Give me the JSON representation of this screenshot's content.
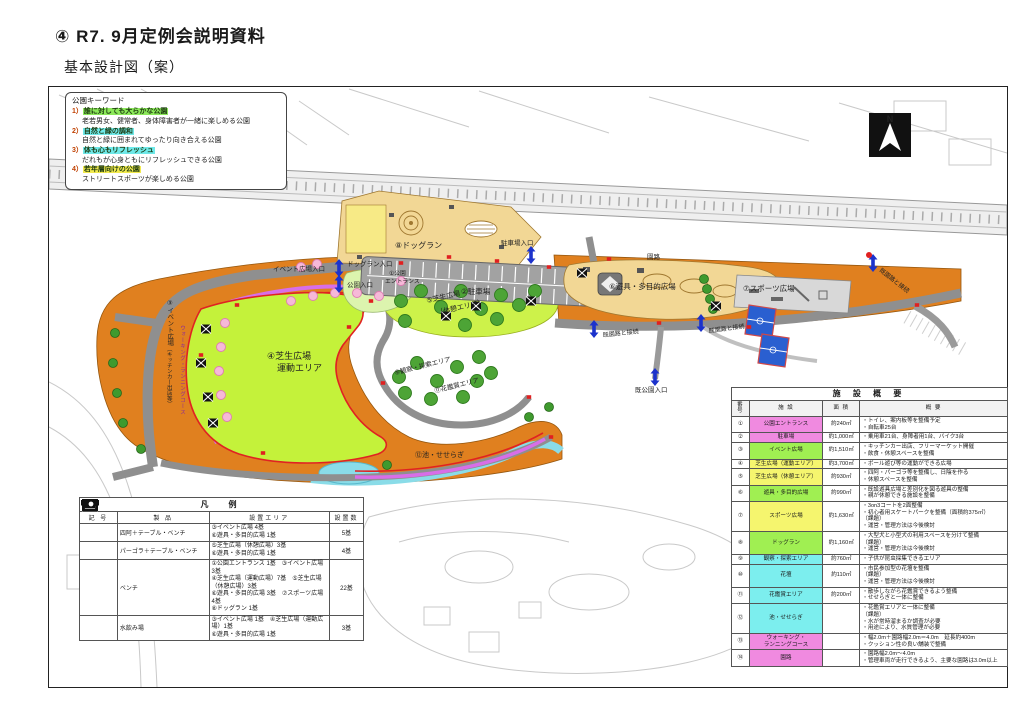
{
  "page": {
    "title": "④ R7. 9月定例会説明資料",
    "subtitle": "基本設計図（案）"
  },
  "keywords": {
    "title": "公園キーワード",
    "items": [
      {
        "no": "1）",
        "head": "誰に対しても大らかな公園",
        "desc": "老若男女、健常者、身体障害者が一緒に楽しめる公園",
        "color": "#8ce95a"
      },
      {
        "no": "2）",
        "head": "自然と緑の調和",
        "desc": "自然と緑に囲まれてゆったり向き合える公園",
        "color": "#6fe9e9"
      },
      {
        "no": "3）",
        "head": "体も心もリフレッシュ",
        "desc": "だれもが心身ともにリフレッシュできる公園",
        "color": "#6fe9e9"
      },
      {
        "no": "4）",
        "head": "若年層向けの公園",
        "desc": "ストリートスポーツが楽しめる公園",
        "color": "#f2ea4e"
      }
    ]
  },
  "map_labels": {
    "dogrun": "⑧ドッグラン",
    "dogrun_entrance": "ドッグラン入口",
    "park_entrance_small": "公園入口",
    "event_entrance": "イベント広場入口",
    "parking_entrance": "駐車場入口",
    "parking": "②駐車場",
    "entrance_1a": "①公園",
    "entrance_1b": "エントランス",
    "event_plaza": "③イベント広場",
    "event_plaza_sub": "（キッチンカー出店等）",
    "lawn_sport_1": "④芝生広場",
    "lawn_sport_2": "運動エリア",
    "lawn_rest_1": "⑤芝生広場",
    "lawn_rest_2": "（休憩エリア）",
    "playground": "⑥遊具・多目的広場",
    "sports": "⑦スポーツ広場",
    "observe": "⑨観察・探索エリア",
    "flower_view": "⑪花鑑賞エリア",
    "pond": "⑫池・せせらぎ",
    "path": "園路",
    "connect_left": "既園路と接続",
    "connect_right": "既園路と接続",
    "connect_far": "既園路と接続",
    "existing_park_entrance": "既公園入口",
    "walking_course": "ウォーキング・ランニングコース",
    "north": "N"
  },
  "legend": {
    "title": "凡　例",
    "headers": [
      "記 号",
      "製 品",
      "設置エリア",
      "設置数"
    ],
    "rows": [
      {
        "symbol": "azumaya-icon",
        "name": "四阿＋テーブル・ベンチ",
        "areas": "③イベント広場 4基\n⑥遊具・多目的広場 1基",
        "count": "5基"
      },
      {
        "symbol": "pergola-icon",
        "name": "パーゴラ＋テーブル・ベンチ",
        "areas": "⑤芝生広場（休憩広場）3基\n⑥遊具・多目的広場 1基",
        "count": "4基"
      },
      {
        "symbol": "bench-icon",
        "name": "ベンチ",
        "areas": "①公園エントランス 1基　③イベント広場 3基\n④芝生広場（運動広場）7基　⑤芝生広場（休憩広場）3基\n⑥遊具・多目的広場 3基　⑦スポーツ広場 4基\n⑧ドッグラン 1基",
        "count": "22基"
      },
      {
        "symbol": "fountain-icon",
        "name": "水飲み場",
        "areas": "③イベント広場 1基　④芝生広場（運動広場）1基\n⑥遊具・多目的広場 1基",
        "count": "3基"
      }
    ]
  },
  "facilities": {
    "title": "施 設 概 要",
    "headers": [
      "番 号",
      "施 設",
      "面 積",
      "概 要"
    ],
    "rows": [
      {
        "no": "①",
        "name": "公園エントランス",
        "color": "#f08ae0",
        "area": "約240㎡",
        "desc": "・トイレ、案内板等を整備予定\n・自転車25台"
      },
      {
        "no": "②",
        "name": "駐車場",
        "color": "#f08ae0",
        "area": "約1,000㎡",
        "desc": "・乗用車21台、身障者用1台、バイク3台"
      },
      {
        "no": "③",
        "name": "イベント広場",
        "color": "#a0ef52",
        "area": "約1,510㎡",
        "desc": "・キッチンカー出店、フリーマーケット開催\n・飲食・休憩スペースを整備"
      },
      {
        "no": "④",
        "name": "芝生広場（運動エリア）",
        "color": "#f5f56e",
        "area": "約3,700㎡",
        "desc": "・ボール遊び等の運動ができる広場"
      },
      {
        "no": "⑤",
        "name": "芝生広場（休憩エリア）",
        "color": "#f5f56e",
        "area": "約930㎡",
        "desc": "・四阿・パーゴラ等を整備し、日陰を作る\n・休憩スペースを整備"
      },
      {
        "no": "⑥",
        "name": "遊具・多目的広場",
        "color": "#a0ef52",
        "area": "約990㎡",
        "desc": "・既設遊具広場と差別化を図る遊具の整備\n・親が休憩できる施設を整備"
      },
      {
        "no": "⑦",
        "name": "スポーツ広場",
        "color": "#f5f56e",
        "area": "約1,630㎡",
        "desc": "・3on3コートを2面整備\n・初心者用スケートパークを整備（面積約375㎡）\n（課題）\n・運営・管理方法は今後検討"
      },
      {
        "no": "⑧",
        "name": "ドッグラン",
        "color": "#a0ef52",
        "area": "約1,160㎡",
        "desc": "・大型犬と小型犬の利用スペースを分けて整備\n（課題）\n・運営・管理方法は今後検討"
      },
      {
        "no": "⑨",
        "name": "観察・探索エリア",
        "color": "#7ceeee",
        "area": "約760㎡",
        "desc": "・子供が昆虫採集できるエリア"
      },
      {
        "no": "⑩",
        "name": "花壇",
        "color": "#7ceeee",
        "area": "約110㎡",
        "desc": "・市民参加型の花壇を整備\n（課題）\n・運営・管理方法は今後検討"
      },
      {
        "no": "⑪",
        "name": "花鑑賞エリア",
        "color": "#7ceeee",
        "area": "約200㎡",
        "desc": "・散歩しながら花鑑賞できるよう整備\n・せせらぎと一体に整備"
      },
      {
        "no": "⑫",
        "name": "池・せせらぎ",
        "color": "#7ceeee",
        "area": "",
        "desc": "・花鑑賞エリアと一体に整備\n（課題）\n・水が常時溜まるか調査が必要\n・用途により、水質管理が必要"
      },
      {
        "no": "⑬",
        "name": "ウォーキング・\nランニングコース",
        "color": "#f08ae0",
        "area": "",
        "desc": "・幅2.0m＋園路幅2.0m＝4.0m　延長約400m\n・クッション性の良い舗装で整備"
      },
      {
        "no": "⑭",
        "name": "園路",
        "color": "#f08ae0",
        "area": "",
        "desc": "・園路幅2.0m～4.0m\n・管理車両が走行できるよう、主要な園路は3.0m以上"
      }
    ]
  }
}
